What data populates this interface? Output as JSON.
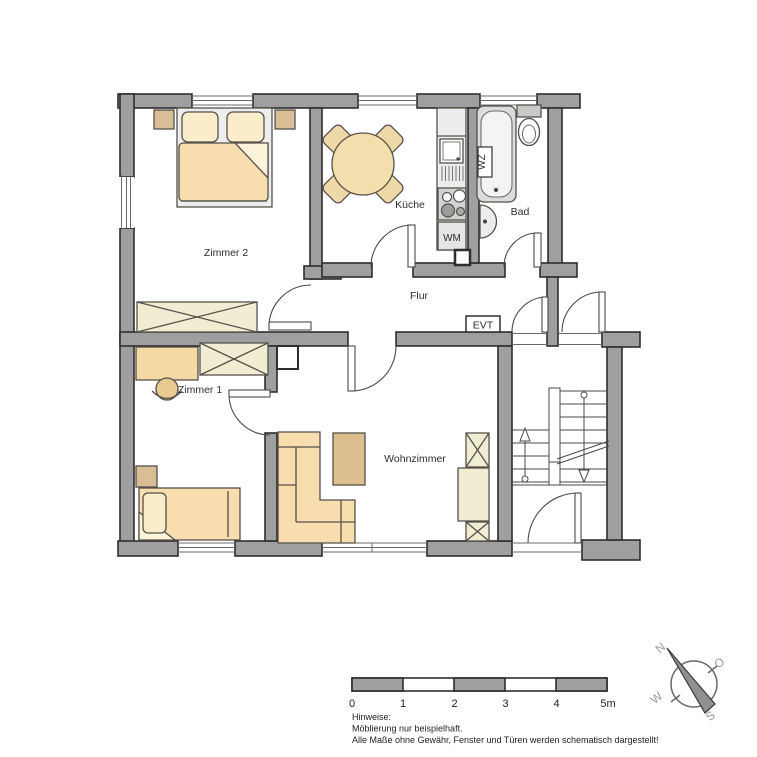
{
  "rooms": [
    {
      "id": "zimmer2",
      "label": "Zimmer 2"
    },
    {
      "id": "kueche",
      "label": "Küche"
    },
    {
      "id": "bad",
      "label": "Bad"
    },
    {
      "id": "flur",
      "label": "Flur"
    },
    {
      "id": "zimmer1",
      "label": "Zimmer 1"
    },
    {
      "id": "wohnzimmer",
      "label": "Wohnzimmer"
    }
  ],
  "annotations": {
    "washing_machine": "WM",
    "water_heater": "WZ",
    "electrical": "EVT"
  },
  "scale_bar": {
    "ticks": [
      "0",
      "1",
      "2",
      "3",
      "4",
      "5m"
    ],
    "length_meters": 5
  },
  "notes": {
    "heading": "Hinweise:",
    "lines": [
      "Möblierung nur beispielhaft.",
      "Alle Maße ohne Gewähr, Fenster und Türen werden schematisch dargestellt!"
    ]
  },
  "compass": {
    "north": "N",
    "east": "O",
    "south": "S",
    "west": "W"
  },
  "colors": {
    "wall": "#9f9f9f",
    "outline": "#2e2e2e",
    "furniture_light": "#f8ddae",
    "furniture_pale": "#fbecca",
    "furniture_dark": "#d9bd94",
    "cabinet": "#f1edd2",
    "fixture": "#dcdcdc"
  }
}
